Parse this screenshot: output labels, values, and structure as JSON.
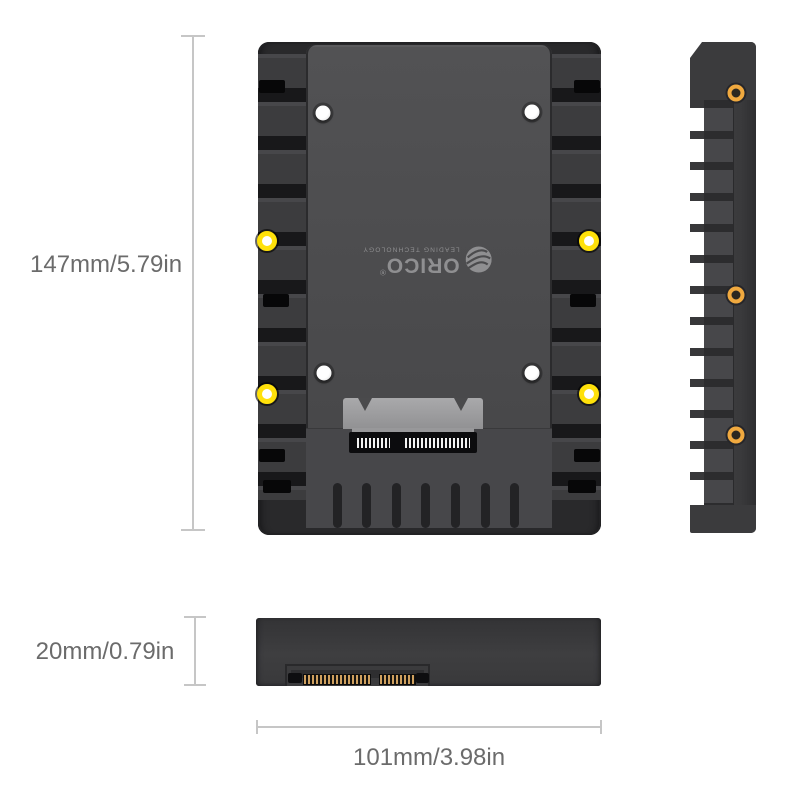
{
  "brand": {
    "name": "ORICO",
    "registered": "®",
    "tagline": "LEADING TECHNOLOGY"
  },
  "dimensions": {
    "height_label": "147mm/5.79in",
    "thickness_label": "20mm/0.79in",
    "width_label": "101mm/3.98in"
  },
  "colors": {
    "background": "#ffffff",
    "frame_dark": "#29292b",
    "rail_ridge": "#3c3c3e",
    "tray_gray": "#4b4b4d",
    "logo_gray": "#8f8f91",
    "connector_silver": "#9c9c9e",
    "screw_ring_yellow": "#ffe10a",
    "screw_ring_gold": "#f0a93f",
    "sata_pin_gold": "#cfa05f",
    "dimension_line": "#c6c6c6",
    "dimension_text": "#6b6b6b"
  }
}
